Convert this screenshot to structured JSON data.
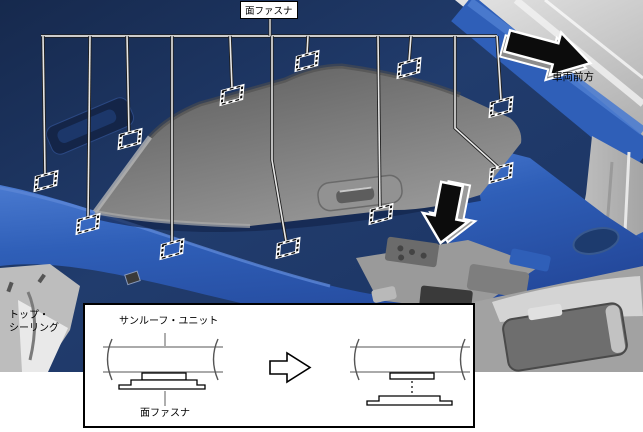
{
  "diagram": {
    "fastener_label": "面ファスナ",
    "vehicle_front_label": "車両前方",
    "top_ceiling_lines": [
      "トップ・",
      "シーリング"
    ],
    "fastener_markers": [
      {
        "x": 46,
        "y": 181
      },
      {
        "x": 88,
        "y": 224
      },
      {
        "x": 130,
        "y": 139
      },
      {
        "x": 172,
        "y": 249
      },
      {
        "x": 232,
        "y": 95
      },
      {
        "x": 288,
        "y": 248
      },
      {
        "x": 307,
        "y": 61
      },
      {
        "x": 381,
        "y": 214
      },
      {
        "x": 409,
        "y": 68
      },
      {
        "x": 501,
        "y": 107
      },
      {
        "x": 501,
        "y": 173
      }
    ],
    "leader_lines": [
      [
        [
          43,
          36
        ],
        [
          45,
          174
        ]
      ],
      [
        [
          90,
          36
        ],
        [
          88,
          217
        ]
      ],
      [
        [
          127,
          36
        ],
        [
          129,
          132
        ]
      ],
      [
        [
          172,
          36
        ],
        [
          172,
          242
        ]
      ],
      [
        [
          230,
          36
        ],
        [
          232,
          88
        ]
      ],
      [
        [
          272,
          36
        ],
        [
          272,
          160
        ],
        [
          286,
          241
        ]
      ],
      [
        [
          308,
          36
        ],
        [
          307,
          54
        ]
      ],
      [
        [
          378,
          36
        ],
        [
          380,
          207
        ]
      ],
      [
        [
          411,
          36
        ],
        [
          409,
          61
        ]
      ],
      [
        [
          497,
          36
        ],
        [
          501,
          100
        ]
      ],
      [
        [
          455,
          36
        ],
        [
          455,
          128
        ],
        [
          498,
          167
        ]
      ]
    ],
    "bus_line": [
      [
        41,
        36
      ],
      [
        497,
        36
      ]
    ],
    "label_connector": [
      [
        270,
        17
      ],
      [
        270,
        36
      ]
    ]
  },
  "inset": {
    "sunroof_unit_label": "サンルーフ・ユニット",
    "fastener_label": "面ファスナ"
  },
  "colors": {
    "headliner_navy": "#1e3a66",
    "trim_blue": "#2f5fb8",
    "shade_gray": "#7d7d7d",
    "pillar_gray": "#c6c6c6",
    "arrow_black": "#0c0c0c",
    "marker_dash_black": "#111111",
    "marker_dash_white": "#ffffff"
  }
}
